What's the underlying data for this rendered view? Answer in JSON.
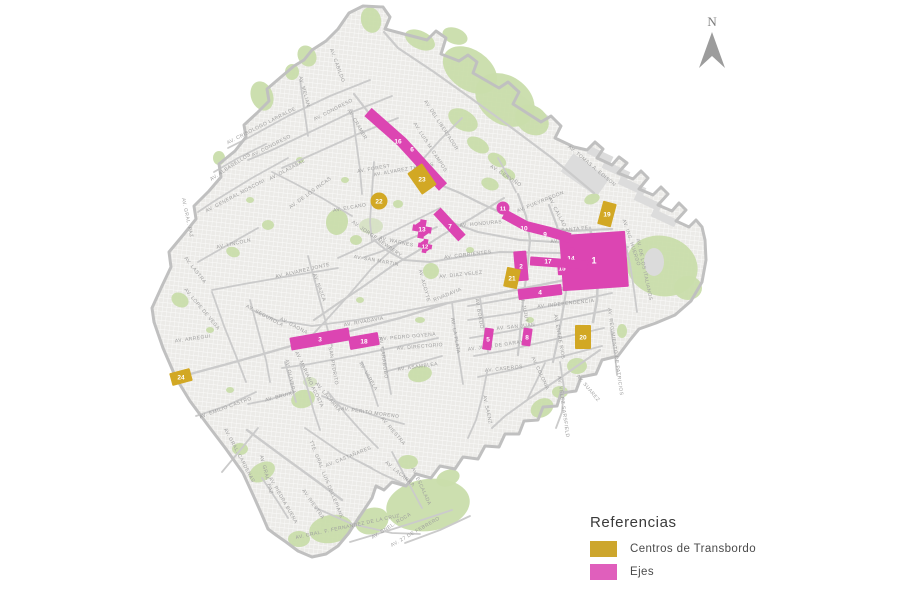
{
  "legend": {
    "title": "Referencias",
    "items": [
      {
        "label": "Centros de Transbordo",
        "color": "#CDA62D"
      },
      {
        "label": "Ejes",
        "color": "#E05FBC"
      }
    ]
  },
  "compass": {
    "label": "N"
  },
  "map": {
    "colors": {
      "eje": "#DC45B2",
      "centro": "#D2A824",
      "park": "#C9DDAB",
      "park_light": "#D6E2C4",
      "city_fill": "#ECEBE8",
      "grid_line": "#FBFBFA",
      "avenue": "#CBCBCB",
      "boundary": "#C0C0C0",
      "street_label": "#9E9E9E",
      "gray_infra": "#DCDCDC"
    },
    "streets": [
      [
        "AV. CABILDO",
        336,
        66,
        70
      ],
      [
        "AV. MELIAN",
        303,
        92,
        75
      ],
      [
        "AV. CRISOLOGO LARRALDE",
        262,
        127,
        -27
      ],
      [
        "AV. CONGRESO",
        272,
        147,
        -27
      ],
      [
        "AV. CONGRESO",
        334,
        111,
        -27
      ],
      [
        "AV. CRAMER",
        356,
        125,
        60
      ],
      [
        "AV. FOREST",
        374,
        170,
        -10
      ],
      [
        "AV. ALVAREZ THOMAS",
        404,
        171,
        -10
      ],
      [
        "AV. OLAZABAL",
        288,
        171,
        -28
      ],
      [
        "AV. ALBARELLOS",
        231,
        168,
        -33
      ],
      [
        "AV. GENERAL MOSCONI",
        236,
        197,
        -28
      ],
      [
        "AV. DE LOS INCAS",
        311,
        194,
        -36
      ],
      [
        "AV. LINCOLN",
        234,
        245,
        -12
      ],
      [
        "AV. GRAL. PAZ",
        186,
        218,
        78
      ],
      [
        "AV. LASTRA",
        194,
        271,
        52
      ],
      [
        "AV. ALVAREZ JONTE",
        303,
        272,
        -13
      ],
      [
        "AV. SAN MARTIN",
        376,
        262,
        10
      ],
      [
        "AV. ELCANO",
        350,
        209,
        -10
      ],
      [
        "AV. JORGE NEWBERY",
        376,
        240,
        35
      ],
      [
        "AV. WARNES",
        396,
        243,
        12
      ],
      [
        "AV. DEL LIBERTADOR",
        440,
        126,
        57
      ],
      [
        "AV. LUIS M. CAMPOS",
        429,
        148,
        57
      ],
      [
        "AV. CERVIÑO",
        505,
        177,
        33
      ],
      [
        "AV. TOMAS A. EDISON",
        591,
        167,
        40
      ],
      [
        "AV. PUEYRREDON",
        541,
        203,
        -22
      ],
      [
        "AV. CALLAO",
        556,
        213,
        62
      ],
      [
        "AV. SANTA FE",
        570,
        231,
        -6
      ],
      [
        "AV. CORDOBA",
        570,
        241,
        -6
      ],
      [
        "AV. HONDURAS",
        481,
        225,
        -5
      ],
      [
        "AV. CORRIENTES",
        468,
        256,
        -7
      ],
      [
        "AV. DIAZ VELEZ",
        461,
        276,
        -6
      ],
      [
        "RIVADAVIA",
        448,
        296,
        -22
      ],
      [
        "AV. ACOYTE",
        423,
        286,
        75
      ],
      [
        "AV. RIVADAVIA",
        364,
        323,
        -10
      ],
      [
        "AV. DE MAYO",
        586,
        278,
        -8
      ],
      [
        "AV. BELGRANO",
        571,
        290,
        -6
      ],
      [
        "AV. INDEPENDENCIA",
        566,
        305,
        -6
      ],
      [
        "AV. SAN JUAN",
        516,
        328,
        -6
      ],
      [
        "AV. JUAN DE GARAY",
        496,
        347,
        -8
      ],
      [
        "AV. CASEROS",
        504,
        370,
        -6
      ],
      [
        "AV. JUJUY",
        523,
        309,
        78
      ],
      [
        "AV. BOEDO",
        478,
        314,
        80
      ],
      [
        "AV. LA PLATA",
        454,
        336,
        80
      ],
      [
        "AV. ENTRE RIOS",
        558,
        337,
        80
      ],
      [
        "AV. COLONIA",
        539,
        374,
        65
      ],
      [
        "AV. SAENZ",
        486,
        410,
        78
      ],
      [
        "AV. VELEZ SARSFIELD",
        562,
        407,
        82
      ],
      [
        "AV. SUAREZ",
        587,
        389,
        50
      ],
      [
        "AV. REGIMIENTO DE PATRICIOS",
        614,
        352,
        82
      ],
      [
        "AV. ING. HUERGO",
        630,
        243,
        72
      ],
      [
        "AV. DE LOS ITALIANOS",
        643,
        270,
        78
      ],
      [
        "AV. PEDRO GOYENA",
        408,
        338,
        -5
      ],
      [
        "AV. DIRECTORIO",
        420,
        348,
        -5
      ],
      [
        "AV. ASAMBLEA",
        418,
        368,
        -8
      ],
      [
        "AV. SAN PEDRITO",
        331,
        361,
        80
      ],
      [
        "AV. CARABOBO",
        382,
        358,
        82
      ],
      [
        "AV. MARIANO ACOSTA",
        308,
        380,
        65
      ],
      [
        "AV. VARELA",
        367,
        377,
        60
      ],
      [
        "AV. OLIVERA",
        289,
        377,
        78
      ],
      [
        "AV. GAONA",
        293,
        327,
        28
      ],
      [
        "AV. SEGUROLA",
        264,
        317,
        28
      ],
      [
        "AV. LOPE DE VEGA",
        201,
        310,
        50
      ],
      [
        "AV. ARREGUI",
        193,
        340,
        -8
      ],
      [
        "AV. EMILIO CASTRO",
        226,
        409,
        -20
      ],
      [
        "AV. BRUIX",
        279,
        398,
        -15
      ],
      [
        "AV. PERITO MORENO",
        370,
        414,
        8
      ],
      [
        "AV. LACARRA",
        399,
        475,
        40
      ],
      [
        "AV. LACARRA",
        327,
        398,
        50
      ],
      [
        "AV. RIESTRA",
        392,
        432,
        50
      ],
      [
        "AV. RIESTRA",
        312,
        505,
        55
      ],
      [
        "AV. CASTAÑARES",
        349,
        458,
        -22
      ],
      [
        "TTE. GRAL. LUIS DELLEPIANE",
        325,
        480,
        68
      ],
      [
        "AV. PIEDRA BUENA",
        282,
        501,
        60
      ],
      [
        "AV. GRAL. CARDENAS",
        238,
        456,
        62
      ],
      [
        "AV. GRAL. PAZ",
        265,
        475,
        75
      ],
      [
        "AV. GRAL. F. FERNANDEZ DE LA CRUZ",
        348,
        528,
        -12
      ],
      [
        "AV. CNEL. ROCA",
        392,
        527,
        -32
      ],
      [
        "AV. 27 DE FEBRERO",
        416,
        533,
        -30
      ],
      [
        "AV. ESCALADA",
        420,
        487,
        65
      ],
      [
        "AV. NAZCA",
        318,
        288,
        70
      ]
    ],
    "ejes": [
      {
        "id": "1",
        "kind": "rect",
        "x": 594,
        "y": 261,
        "w": 66,
        "h": 56,
        "rot": -4,
        "big": true
      },
      {
        "id": "2",
        "kind": "rect",
        "x": 521,
        "y": 266,
        "w": 13,
        "h": 30,
        "rot": -5
      },
      {
        "id": "3",
        "kind": "rect",
        "x": 320,
        "y": 339,
        "w": 60,
        "h": 13,
        "rot": -10
      },
      {
        "id": "4",
        "kind": "rect",
        "x": 540,
        "y": 292,
        "w": 44,
        "h": 11,
        "rot": -7
      },
      {
        "id": "5",
        "kind": "rect",
        "x": 488,
        "y": 339,
        "w": 9,
        "h": 22,
        "rot": 8
      },
      {
        "id": "6",
        "kind": "band",
        "pts": [
          [
            368,
            112
          ],
          [
            402,
            142
          ],
          [
            443,
            187
          ]
        ],
        "w": 11,
        "labels": [
          {
            "t": "16",
            "x": 398,
            "y": 141
          },
          {
            "t": "6",
            "x": 412,
            "y": 149
          }
        ]
      },
      {
        "id": "7",
        "kind": "band",
        "pts": [
          [
            437,
            211
          ],
          [
            462,
            238
          ]
        ],
        "w": 10,
        "labels": [
          {
            "t": "7",
            "x": 450,
            "y": 226
          }
        ]
      },
      {
        "id": "8",
        "kind": "rect",
        "x": 527,
        "y": 337,
        "w": 9,
        "h": 18,
        "rot": 8
      },
      {
        "id": "9",
        "kind": "band",
        "pts": [
          [
            504,
            214
          ],
          [
            526,
            226
          ],
          [
            550,
            232
          ],
          [
            570,
            238
          ]
        ],
        "w": 10,
        "labels": [
          {
            "t": "10",
            "x": 524,
            "y": 228
          },
          {
            "t": "9",
            "x": 545,
            "y": 234
          }
        ]
      },
      {
        "id": "11",
        "kind": "dot",
        "x": 503,
        "y": 208,
        "r": 6.5,
        "small": true
      },
      {
        "id": "12",
        "kind": "cross",
        "x": 425,
        "y": 246,
        "s": 14
      },
      {
        "id": "13",
        "kind": "cross",
        "x": 422,
        "y": 229,
        "s": 19
      },
      {
        "id": "14",
        "kind": "rect",
        "x": 571,
        "y": 258,
        "w": 9,
        "h": 20,
        "rot": -4
      },
      {
        "id": "15",
        "kind": "rect",
        "x": 562,
        "y": 268,
        "w": 9,
        "h": 14,
        "rot": -4
      },
      {
        "id": "17",
        "kind": "rect",
        "x": 559,
        "y": 263,
        "w": 58,
        "h": 9,
        "rot": 4,
        "lx": 548,
        "ly": 261
      },
      {
        "id": "18",
        "kind": "rect",
        "x": 364,
        "y": 341,
        "w": 30,
        "h": 13,
        "rot": -10
      }
    ],
    "centros": [
      {
        "id": "19",
        "kind": "rect",
        "x": 607,
        "y": 214,
        "w": 14,
        "h": 24,
        "rot": 15
      },
      {
        "id": "20",
        "kind": "rect",
        "x": 583,
        "y": 337,
        "w": 16,
        "h": 24,
        "rot": 0
      },
      {
        "id": "21",
        "kind": "rect",
        "x": 512,
        "y": 278,
        "w": 14,
        "h": 20,
        "rot": 12
      },
      {
        "id": "22",
        "kind": "dot",
        "x": 379,
        "y": 201,
        "r": 8.5
      },
      {
        "id": "23",
        "kind": "rect",
        "x": 422,
        "y": 179,
        "w": 18,
        "h": 26,
        "rot": -35
      },
      {
        "id": "24",
        "kind": "rect",
        "x": 181,
        "y": 377,
        "w": 21,
        "h": 13,
        "rot": -15
      }
    ]
  }
}
